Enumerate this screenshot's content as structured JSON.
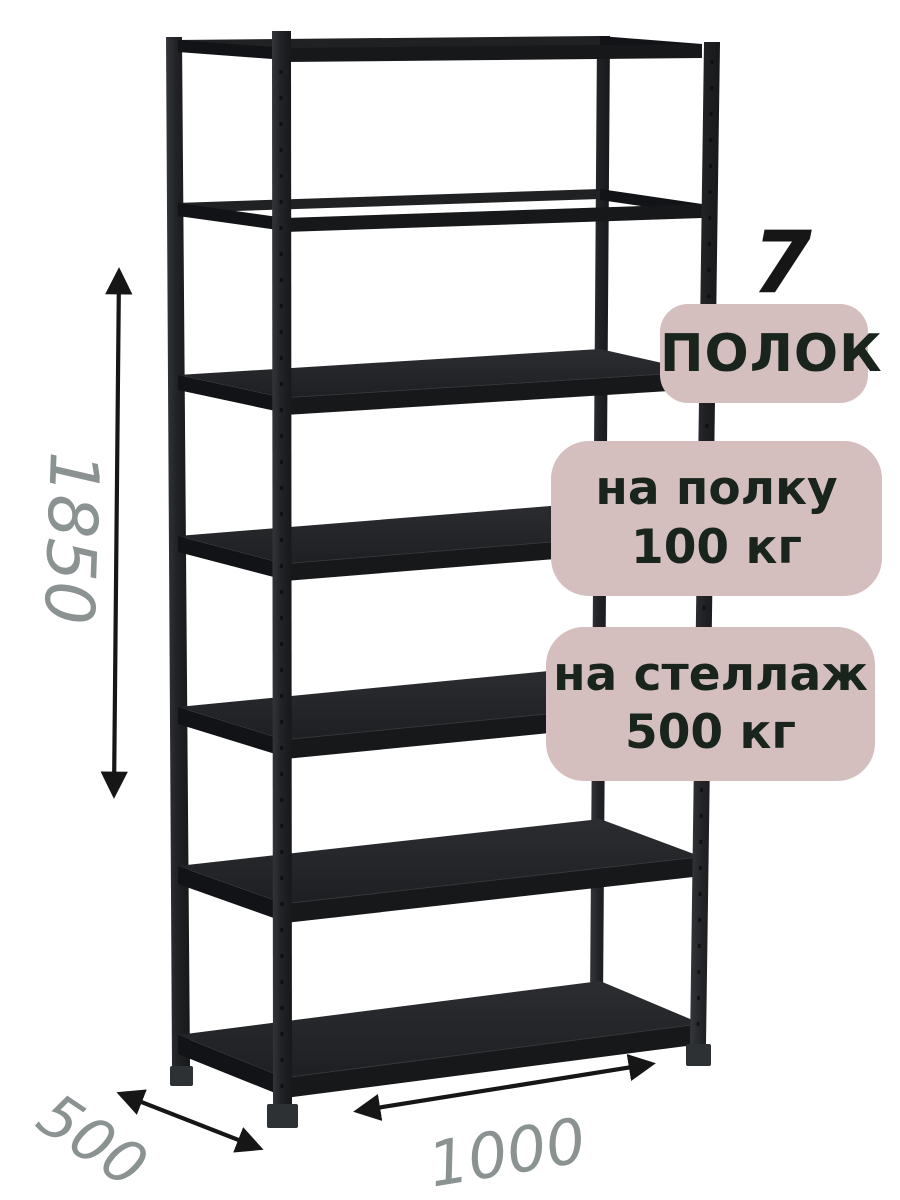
{
  "annotations": {
    "shelf_count_number": "7",
    "shelf_count_label": "ПОЛОК",
    "shelf_load_line1": "на полку",
    "shelf_load_line2": "100 кг",
    "rack_load_line1": "на стеллаж",
    "rack_load_line2": "500 кг"
  },
  "dimensions": {
    "height": "1850",
    "depth": "500",
    "width": "1000"
  },
  "rack": {
    "shelf_count": 7
  },
  "colors": {
    "background": "#ffffff",
    "badge_bg": "#d4bebe",
    "badge_text": "#18241c",
    "dimension_text": "#8b9392",
    "arrow": "#161616",
    "rack_body": "#232528"
  }
}
